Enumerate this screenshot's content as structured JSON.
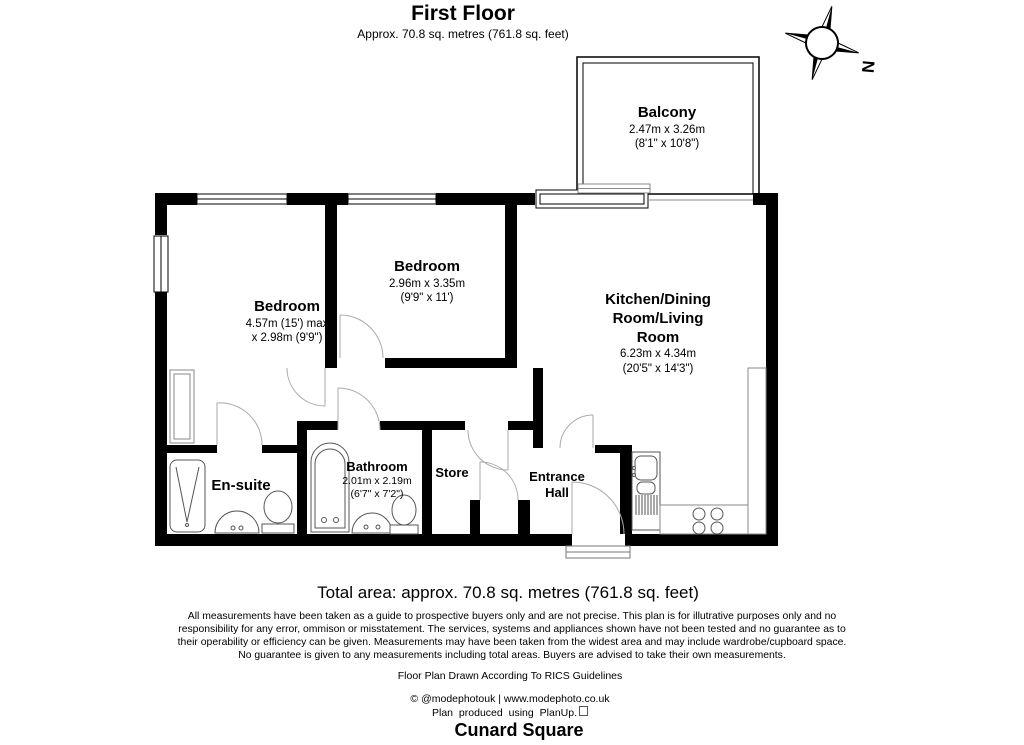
{
  "header": {
    "title": "First Floor",
    "subtitle": "Approx. 70.8 sq. metres (761.8 sq. feet)"
  },
  "compass": {
    "north_label": "N"
  },
  "rooms": {
    "balcony": {
      "name": "Balcony",
      "dim_metric": "2.47m x 3.26m",
      "dim_imperial": "(8'1\" x 10'8\")"
    },
    "bedroom1": {
      "name": "Bedroom",
      "dim_line1": "4.57m (15') max",
      "dim_line2": "x 2.98m (9'9\")"
    },
    "bedroom2": {
      "name": "Bedroom",
      "dim_metric": "2.96m x 3.35m",
      "dim_imperial": "(9'9\" x 11')"
    },
    "kitchen": {
      "name_line1": "Kitchen/Dining",
      "name_line2": "Room/Living",
      "name_line3": "Room",
      "dim_metric": "6.23m x 4.34m",
      "dim_imperial": "(20'5\" x 14'3\")"
    },
    "ensuite": {
      "name": "En-suite"
    },
    "bathroom": {
      "name": "Bathroom",
      "dim_metric": "2.01m x 2.19m",
      "dim_imperial": "(6'7\" x 7'2\")"
    },
    "store": {
      "name": "Store"
    },
    "entrance_hall": {
      "name_line1": "Entrance",
      "name_line2": "Hall"
    }
  },
  "footer": {
    "total_area": "Total area: approx. 70.8 sq. metres (761.8 sq. feet)",
    "disclaimer_line1": "All measurements have been taken as a guide to prospective buyers only and are not precise. This plan is for illutrative purposes only and no",
    "disclaimer_line2": "responsibility for any error, ommison or misstatement. The services, systems and appliances shown have not been tested and no guarantee as to",
    "disclaimer_line3": "their operability or efficiency can be given. Measurements may have been taken from the widest area and may include wardrobe/cupboard space.",
    "disclaimer_line4": "No guarantee is given to any measurements including total areas. Buyers are advised to take their own measurements.",
    "rics": "Floor Plan Drawn According To RICS Guidelines",
    "credit": "© @modephotouk | www.modephoto.co.uk",
    "produced": "Plan produced using PlanUp.",
    "property_name": "Cunard Square"
  },
  "colors": {
    "wall": "#000000",
    "fixture": "#555555",
    "door_arc": "#aaaaaa",
    "counter": "#888888"
  }
}
